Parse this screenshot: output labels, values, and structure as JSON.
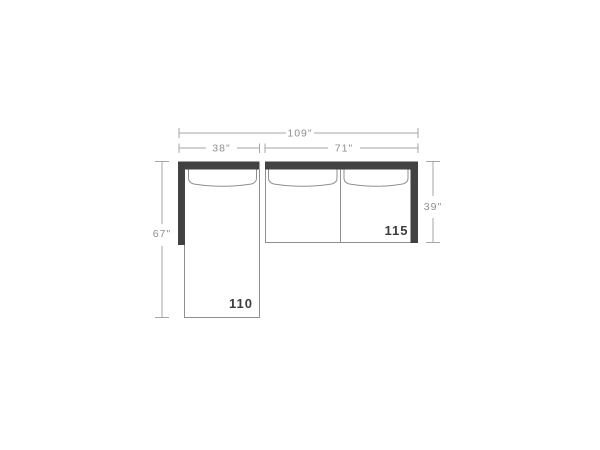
{
  "diagram": {
    "type": "sectional-sofa-top-view-dimension-drawing",
    "dims": {
      "overall_width": "109\"",
      "chaise_section_width": "38\"",
      "sofa_section_width": "71\"",
      "chaise_length": "67\"",
      "sofa_depth": "39\""
    },
    "pieces": {
      "chaise_piece_number": "110",
      "sofa_piece_number": "115"
    },
    "colors": {
      "frame": "#424242",
      "outline": "#8f8f8f",
      "dim_line": "#a6a6a6",
      "dim_text": "#8f8f8f",
      "label_text": "#3d3d3d",
      "background": "#ffffff"
    }
  }
}
